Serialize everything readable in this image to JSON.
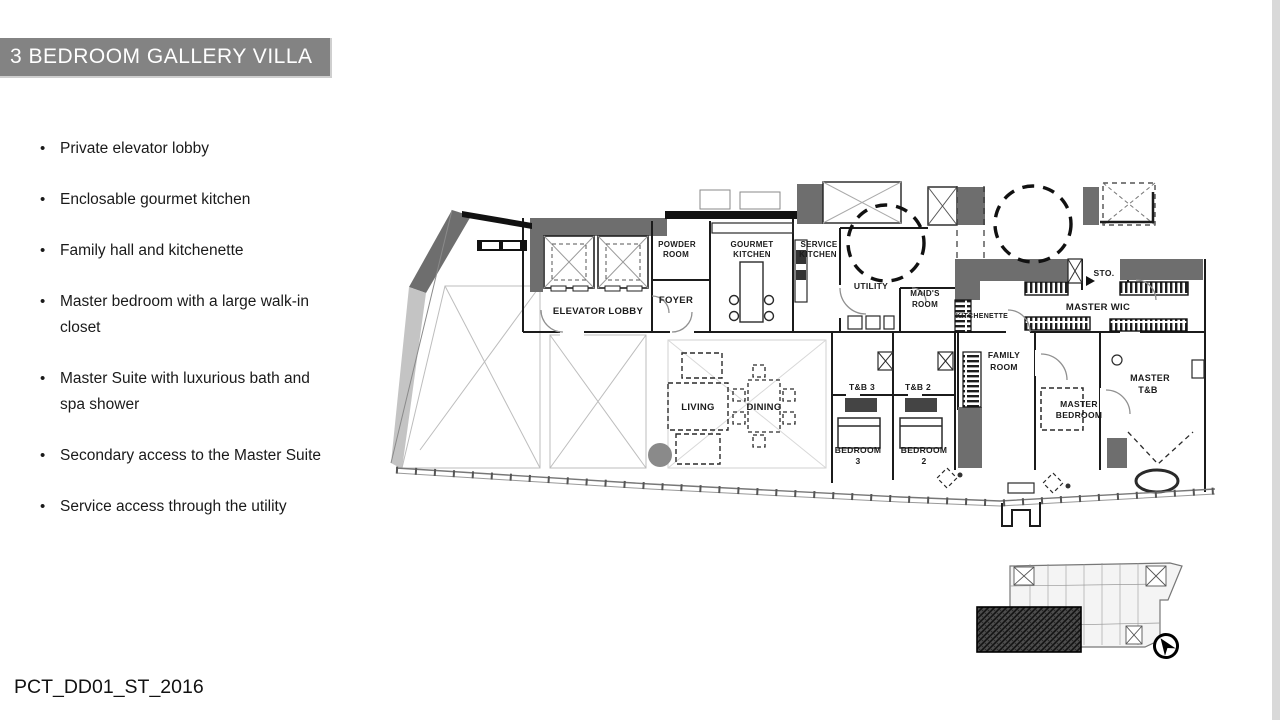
{
  "title_bar": {
    "text": "3 BEDROOM GALLERY VILLA"
  },
  "features": {
    "items": [
      "Private elevator lobby",
      "Enclosable gourmet kitchen",
      "Family hall and kitchenette",
      "Master bedroom with a large walk-in closet",
      "Master Suite with  luxurious bath and spa shower",
      "Secondary access  to the Master Suite",
      "Service access through the utility"
    ]
  },
  "floor_plan": {
    "labels": {
      "elevator_lobby": "ELEVATOR LOBBY",
      "foyer": "FOYER",
      "powder_room": [
        "POWDER",
        "ROOM"
      ],
      "gourmet_kitchen": [
        "GOURMET",
        "KITCHEN"
      ],
      "service_kitchen": [
        "SERVICE",
        "KITCHEN"
      ],
      "utility": "UTILITY",
      "maids_room": [
        "MAID'S",
        "ROOM"
      ],
      "kitchenette": "KITCHENETTE",
      "storage": "STO.",
      "master_wic": "MASTER WIC",
      "living": "LIVING",
      "dining": "DINING",
      "tb3": "T&B 3",
      "tb2": "T&B 2",
      "family_room": [
        "FAMILY",
        "ROOM"
      ],
      "master_bedroom": [
        "MASTER",
        "BEDROOM"
      ],
      "bedroom3": [
        "BEDROOM",
        "3"
      ],
      "bedroom2": [
        "BEDROOM",
        "2"
      ],
      "master_tb": [
        "MASTER",
        "T&B"
      ]
    }
  },
  "footer": {
    "text": "PCT_DD01_ST_2016"
  },
  "colors": {
    "title_bg": "#838383",
    "title_text": "#ffffff",
    "plan_dark_gray": "#6e6e6e",
    "plan_light_gray": "#c4c4c4",
    "line": "#1b1b1b"
  }
}
